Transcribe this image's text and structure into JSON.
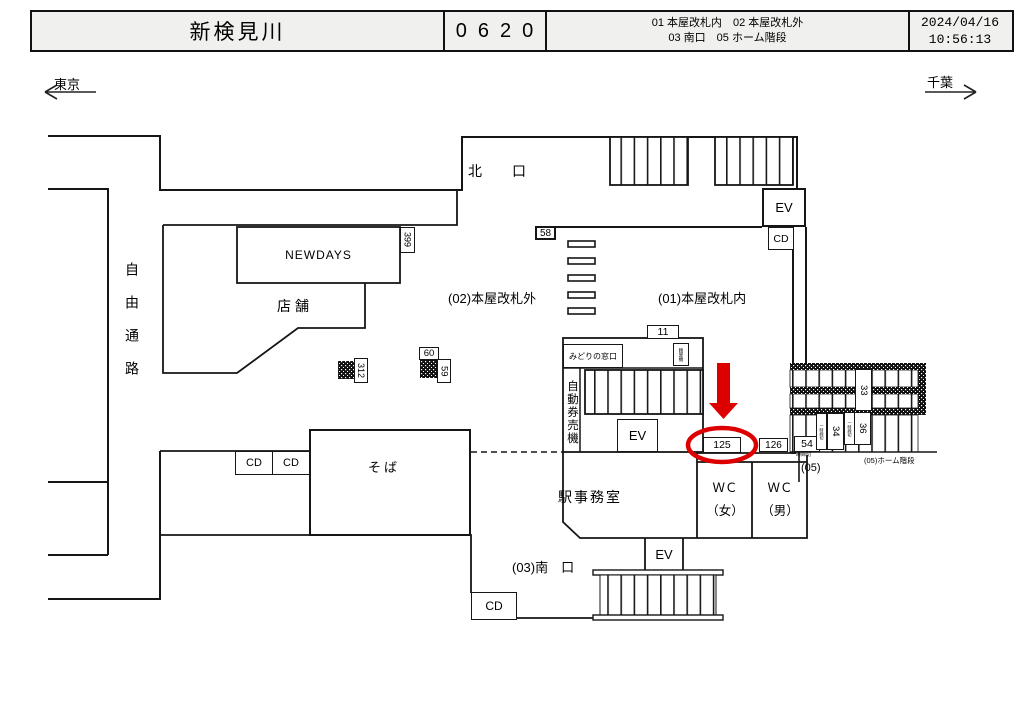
{
  "header": {
    "station": "新検見川",
    "code": "0620",
    "legend1": "01 本屋改札内　02 本屋改札外",
    "legend2": "03 南口　05 ホーム階段",
    "date": "2024/04/16",
    "time": "10:56:13"
  },
  "directions": {
    "left": "東京",
    "right": "千葉"
  },
  "areas": {
    "north_exit": "北　口",
    "south_exit": "(03)南　口",
    "free_passage": "自由通路",
    "outside_gate": "(02)本屋改札外",
    "inside_gate": "(01)本屋改札内",
    "station_office": "駅事務室",
    "platform_stairs": "(05)ホーム階段",
    "gate05": "(05)"
  },
  "facilities": {
    "newdays": "NEWDAYS",
    "store": "店舗",
    "soba": "そば",
    "midori": "みどりの窓口",
    "fare_adjust": "精算機",
    "ticket_machines": "自動券売機",
    "ev": "EV",
    "cd": "CD",
    "wc": "ＷＣ",
    "wc_women": "（女）",
    "wc_men": "（男）",
    "temp_closed": "一時締切"
  },
  "position_ids": {
    "n58": "58",
    "n399": "399",
    "n312": "312",
    "n60": "60",
    "n59": "59",
    "n11": "11",
    "n125": "125",
    "n126": "126",
    "n54": "54",
    "n33": "33",
    "n34": "34",
    "n36": "36"
  },
  "annotation": {
    "target": "125",
    "color": "#dd0000"
  }
}
